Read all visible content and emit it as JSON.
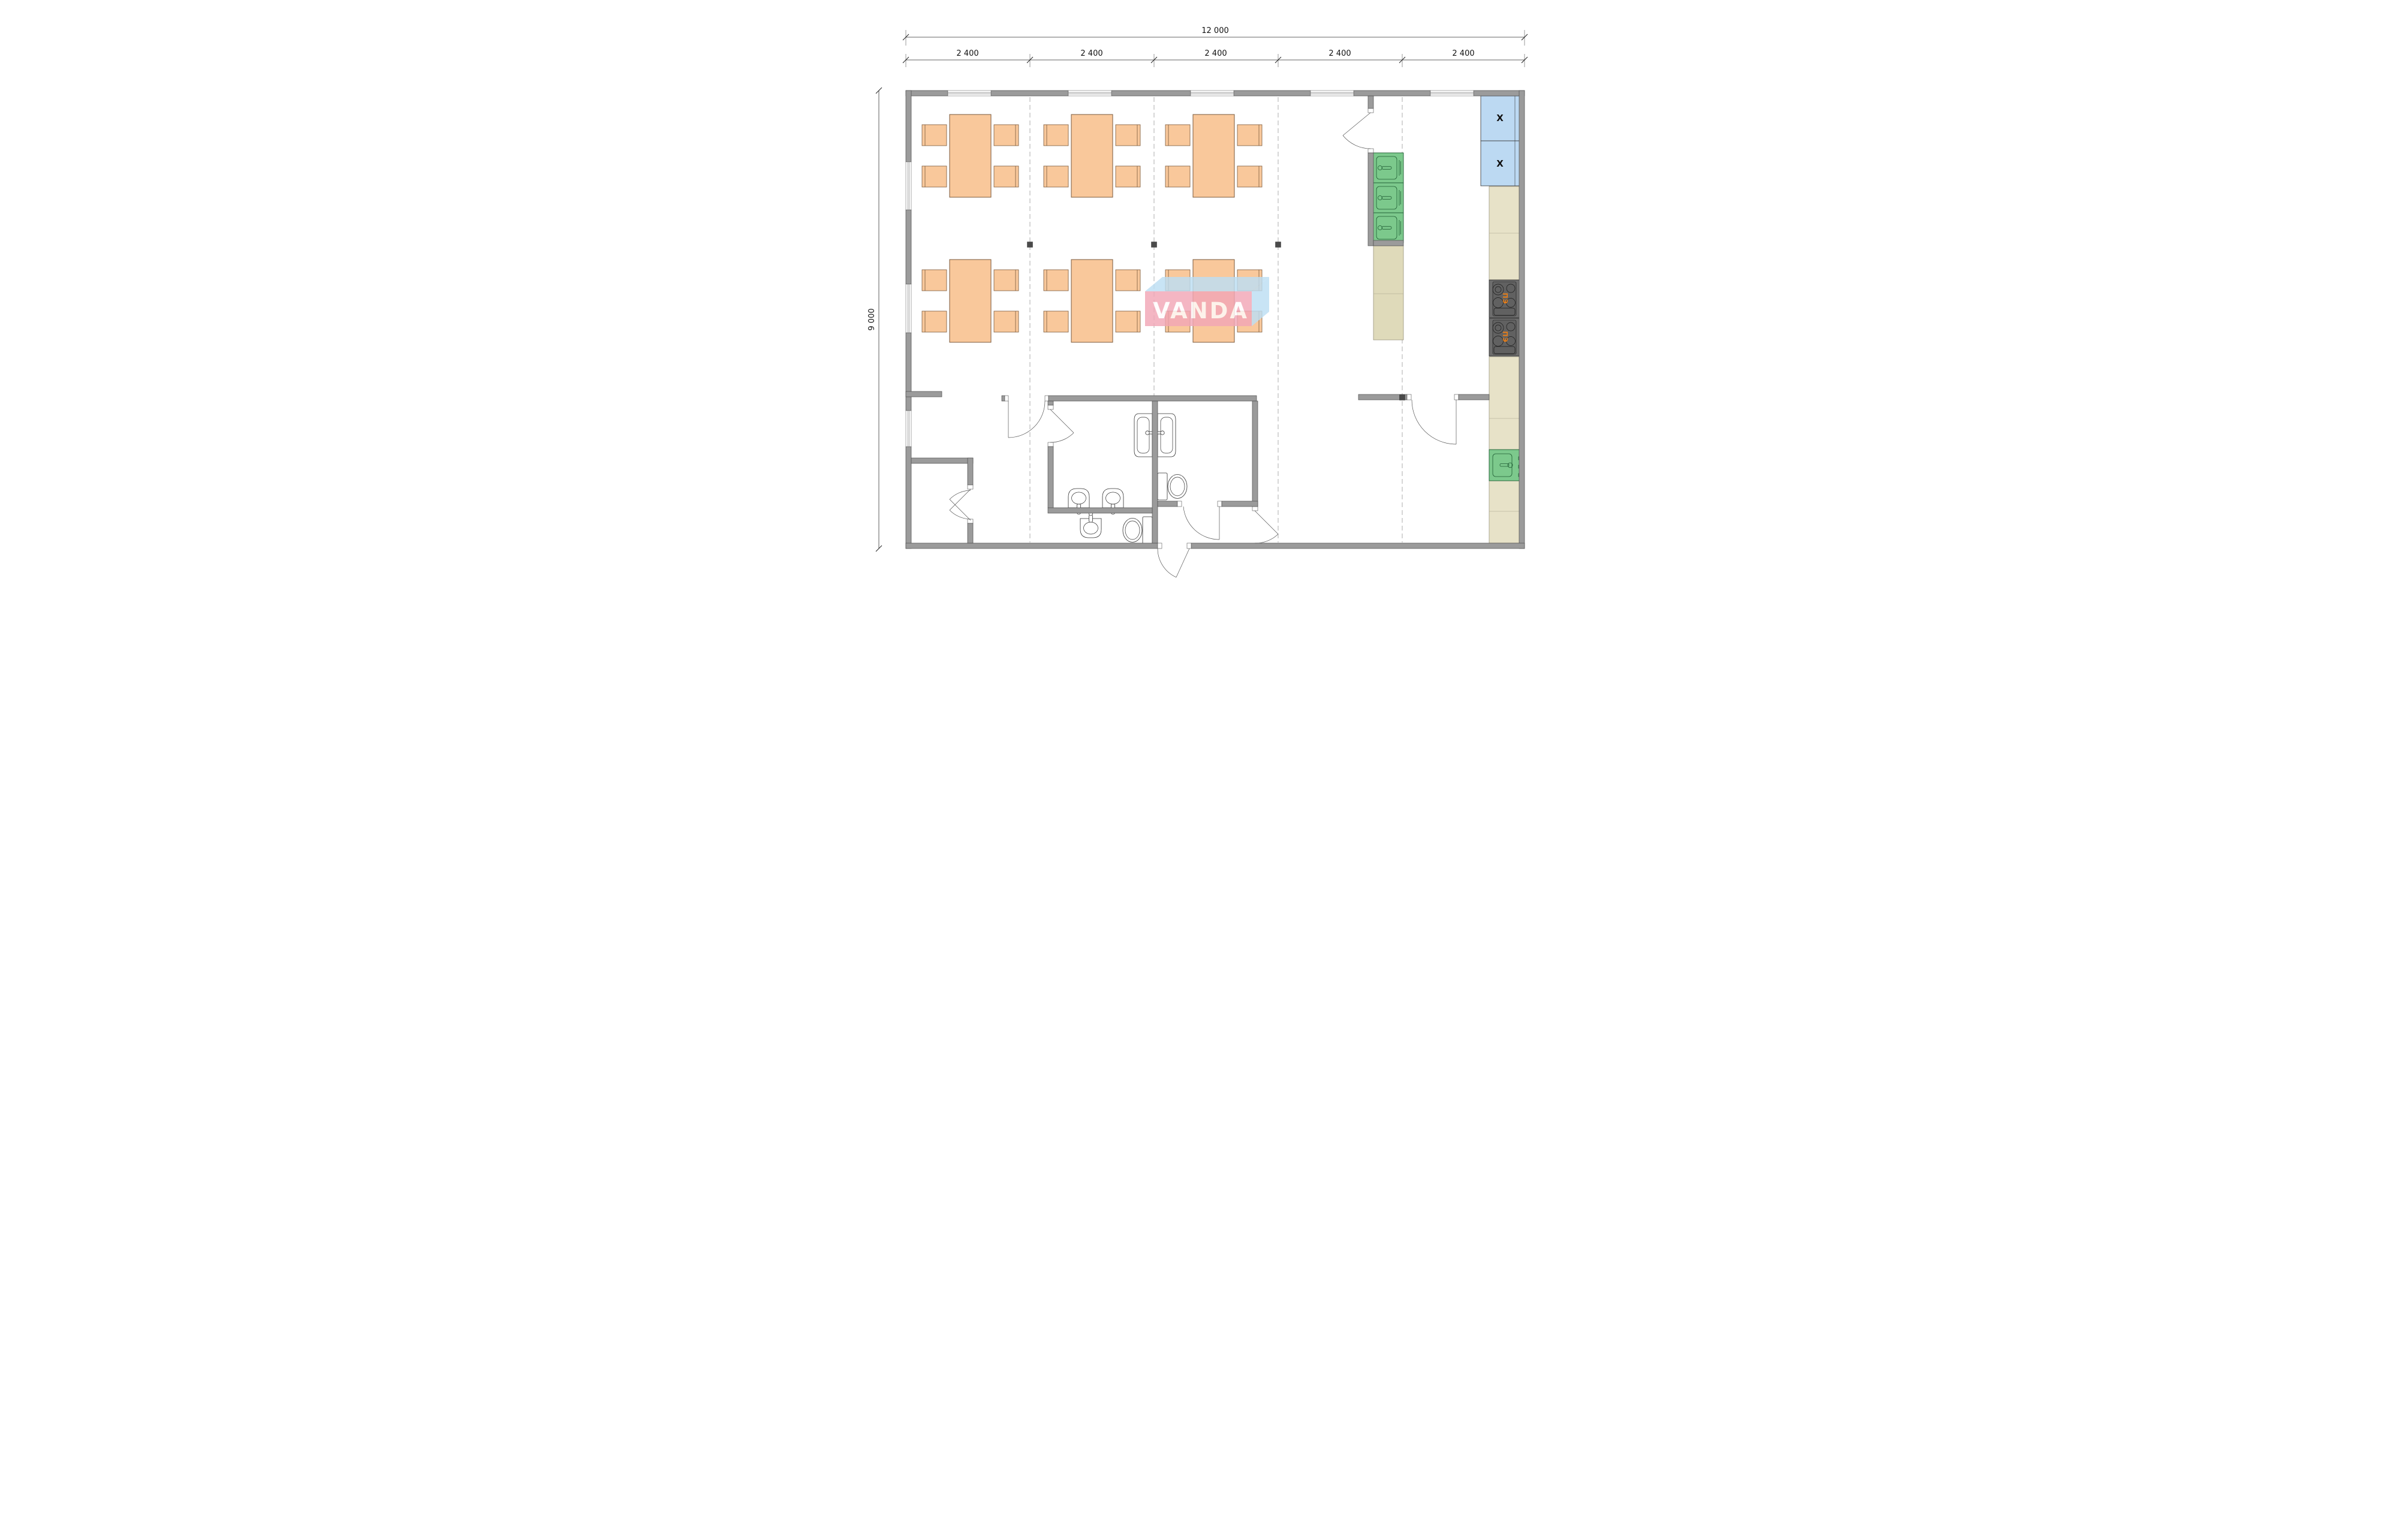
{
  "drawing": {
    "type": "architectural-floor-plan",
    "dimensions": {
      "total_width": "12 000",
      "total_height": "9 000",
      "bays": [
        "2 400",
        "2 400",
        "2 400",
        "2 400",
        "2 400"
      ]
    },
    "watermark": {
      "text": "VANDA"
    },
    "kitchen": {
      "fridge_marks": [
        "X",
        "X"
      ],
      "stove_labels": [
        "ПЭ",
        "ПЭ"
      ]
    },
    "icons": [
      "dining-table-icon",
      "chair-icon",
      "fridge-icon",
      "kitchen-sink-icon",
      "electric-stove-icon",
      "kitchen-counter-icon",
      "toilet-icon",
      "washbasin-icon",
      "door-swing-icon",
      "window-icon",
      "column-marker-icon"
    ],
    "colors": {
      "wall": "#9B9B9B",
      "wall-edge": "#4f4f4f",
      "table": "#F9C89B",
      "table-edge": "#7a5a3c",
      "fridge": "#BCD9F2",
      "sink": "#7CC98C",
      "sink-edge": "#1f5c33",
      "counter": "#DFDABA",
      "counter-right": "#E7E2C8",
      "stove": "#6E6E6E",
      "stove-inner": "#616161",
      "stove-label": "#E87E18",
      "watermark-pink": "#F2A7B6",
      "watermark-blue": "#BDDFF4",
      "line": "#444444",
      "dim": "#333333",
      "grid": "#9a9a9a"
    }
  }
}
